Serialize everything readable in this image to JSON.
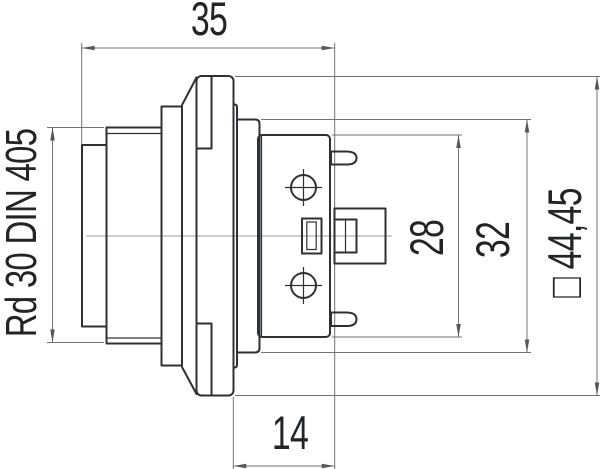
{
  "colors": {
    "background": "#ffffff",
    "outline": "#2d3134",
    "dimension": "#6f7375",
    "arrow": "#55585a",
    "centerline": "#9aa0a3",
    "text": "#212528"
  },
  "drawing": {
    "dimensions": {
      "top_width": "35",
      "thread_spec": "Rd 30 DIN 405",
      "body_height": "28",
      "collar_height": "32",
      "flange_square": "□ 44,45",
      "rear_depth": "14"
    }
  }
}
